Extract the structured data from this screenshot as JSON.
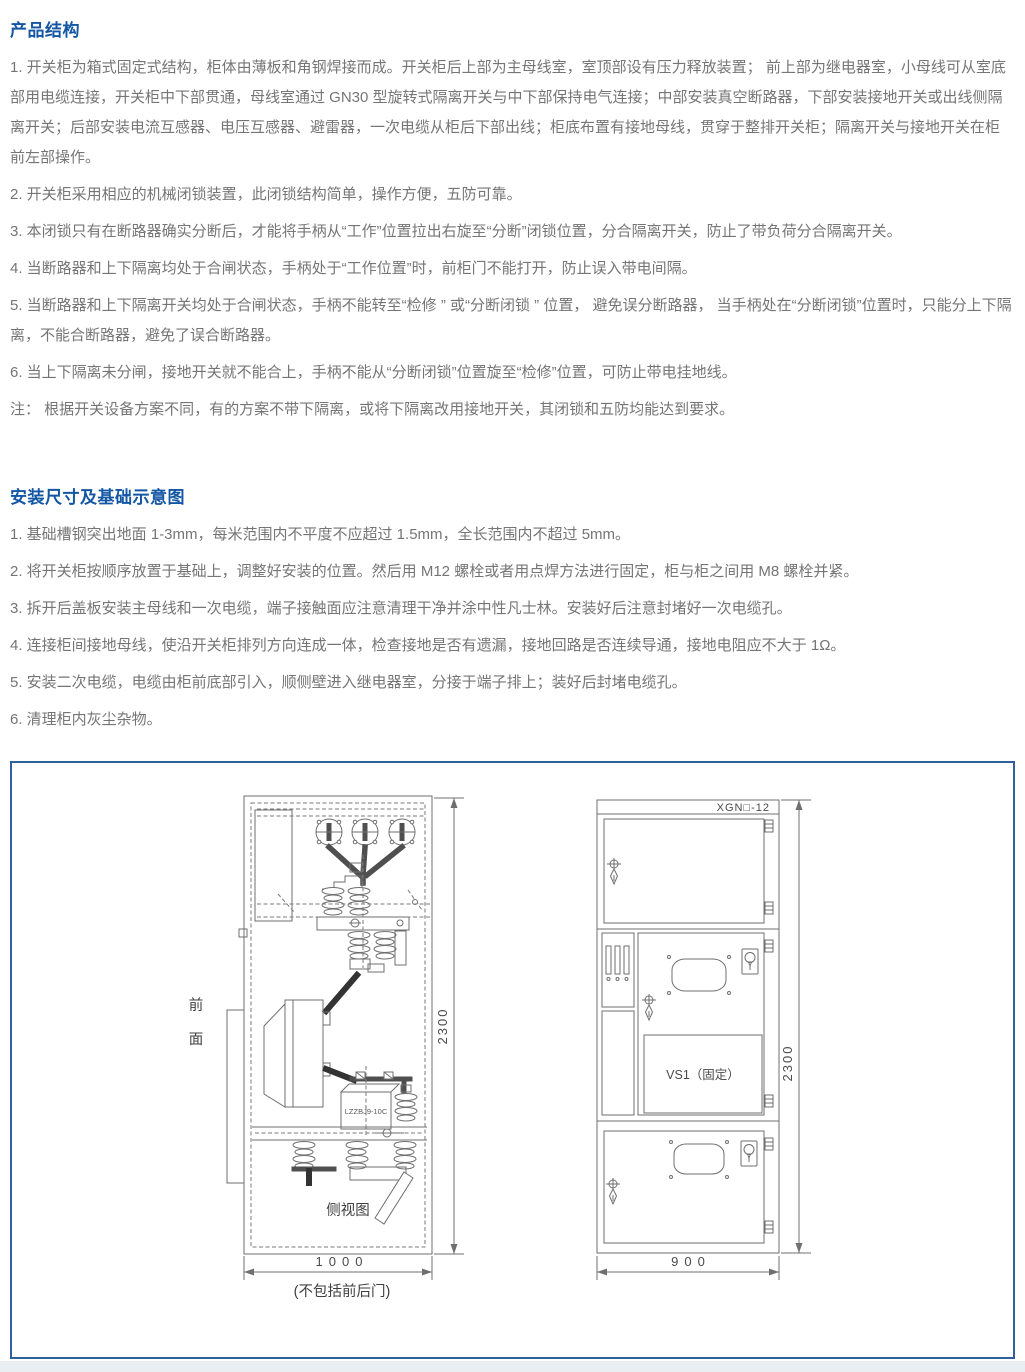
{
  "colors": {
    "heading": "#1356a4",
    "body_text": "#757575",
    "diagram_border": "#2e619c",
    "drawing_line": "#6f6f6f"
  },
  "s1": {
    "title": "产品结构",
    "items": [
      "1. 开关柜为箱式固定式结构，柜体由薄板和角钢焊接而成。开关柜后上部为主母线室，室顶部设有压力释放装置； 前上部为继电器室，小母线可从室底部用电缆连接，开关柜中下部贯通，母线室通过 GN30 型旋转式隔离开关与中下部保持电气连接；中部安装真空断路器，下部安装接地开关或出线侧隔离开关；后部安装电流互感器、电压互感器、避雷器，一次电缆从柜后下部出线；柜底布置有接地母线，贯穿于整排开关柜；隔离开关与接地开关在柜前左部操作。",
      "2. 开关柜采用相应的机械闭锁装置，此闭锁结构简单，操作方便，五防可靠。",
      "3. 本闭锁只有在断路器确实分断后，才能将手柄从“工作”位置拉出右旋至“分断”闭锁位置，分合隔离开关，防止了带负荷分合隔离开关。",
      "4. 当断路器和上下隔离均处于合闸状态，手柄处于“工作位置”时，前柜门不能打开，防止误入带电间隔。",
      "5. 当断路器和上下隔离开关均处于合闸状态，手柄不能转至“检修 ” 或“分断闭锁 ” 位置， 避免误分断路器， 当手柄处在“分断闭锁”位置时，只能分上下隔离，不能合断路器，避免了误合断路器。",
      "6. 当上下隔离未分闸，接地开关就不能合上，手柄不能从“分断闭锁”位置旋至“检修”位置，可防止带电挂地线。",
      "注： 根据开关设备方案不同，有的方案不带下隔离，或将下隔离改用接地开关，其闭锁和五防均能达到要求。"
    ]
  },
  "s2": {
    "title": "安装尺寸及基础示意图",
    "items": [
      "1. 基础槽钢突出地面 1-3mm，每米范围内不平度不应超过 1.5mm，全长范围内不超过 5mm。",
      "2. 将开关柜按顺序放置于基础上，调整好安装的位置。然后用 M12 螺栓或者用点焊方法进行固定，柜与柜之间用 M8 螺栓并紧。",
      "3. 拆开后盖板安装主母线和一次电缆，端子接触面应注意清理干净并涂中性凡士林。安装好后注意封堵好一次电缆孔。",
      "4. 连接柜间接地母线，使沿开关柜排列方向连成一体，检查接地是否有遗漏，接地回路是否连续导通，接地电阻应不大于 1Ω。",
      "5. 安装二次电缆，电缆由柜前底部引入，顺侧壁进入继电器室，分接于端子排上；装好后封堵电缆孔。",
      "6. 清理柜内灰尘杂物。"
    ]
  },
  "diagram": {
    "side": {
      "front_label": [
        "前",
        "面"
      ],
      "caption": "侧视图",
      "ct_label": "LZZBJ9-10C",
      "dim_height": "2300",
      "dim_width": "1000",
      "dim_note": "(不包括前后门)"
    },
    "front": {
      "model": "XGN□-12",
      "vcb_label": "VS1（固定）",
      "dim_height": "2300",
      "dim_width": "900"
    }
  }
}
